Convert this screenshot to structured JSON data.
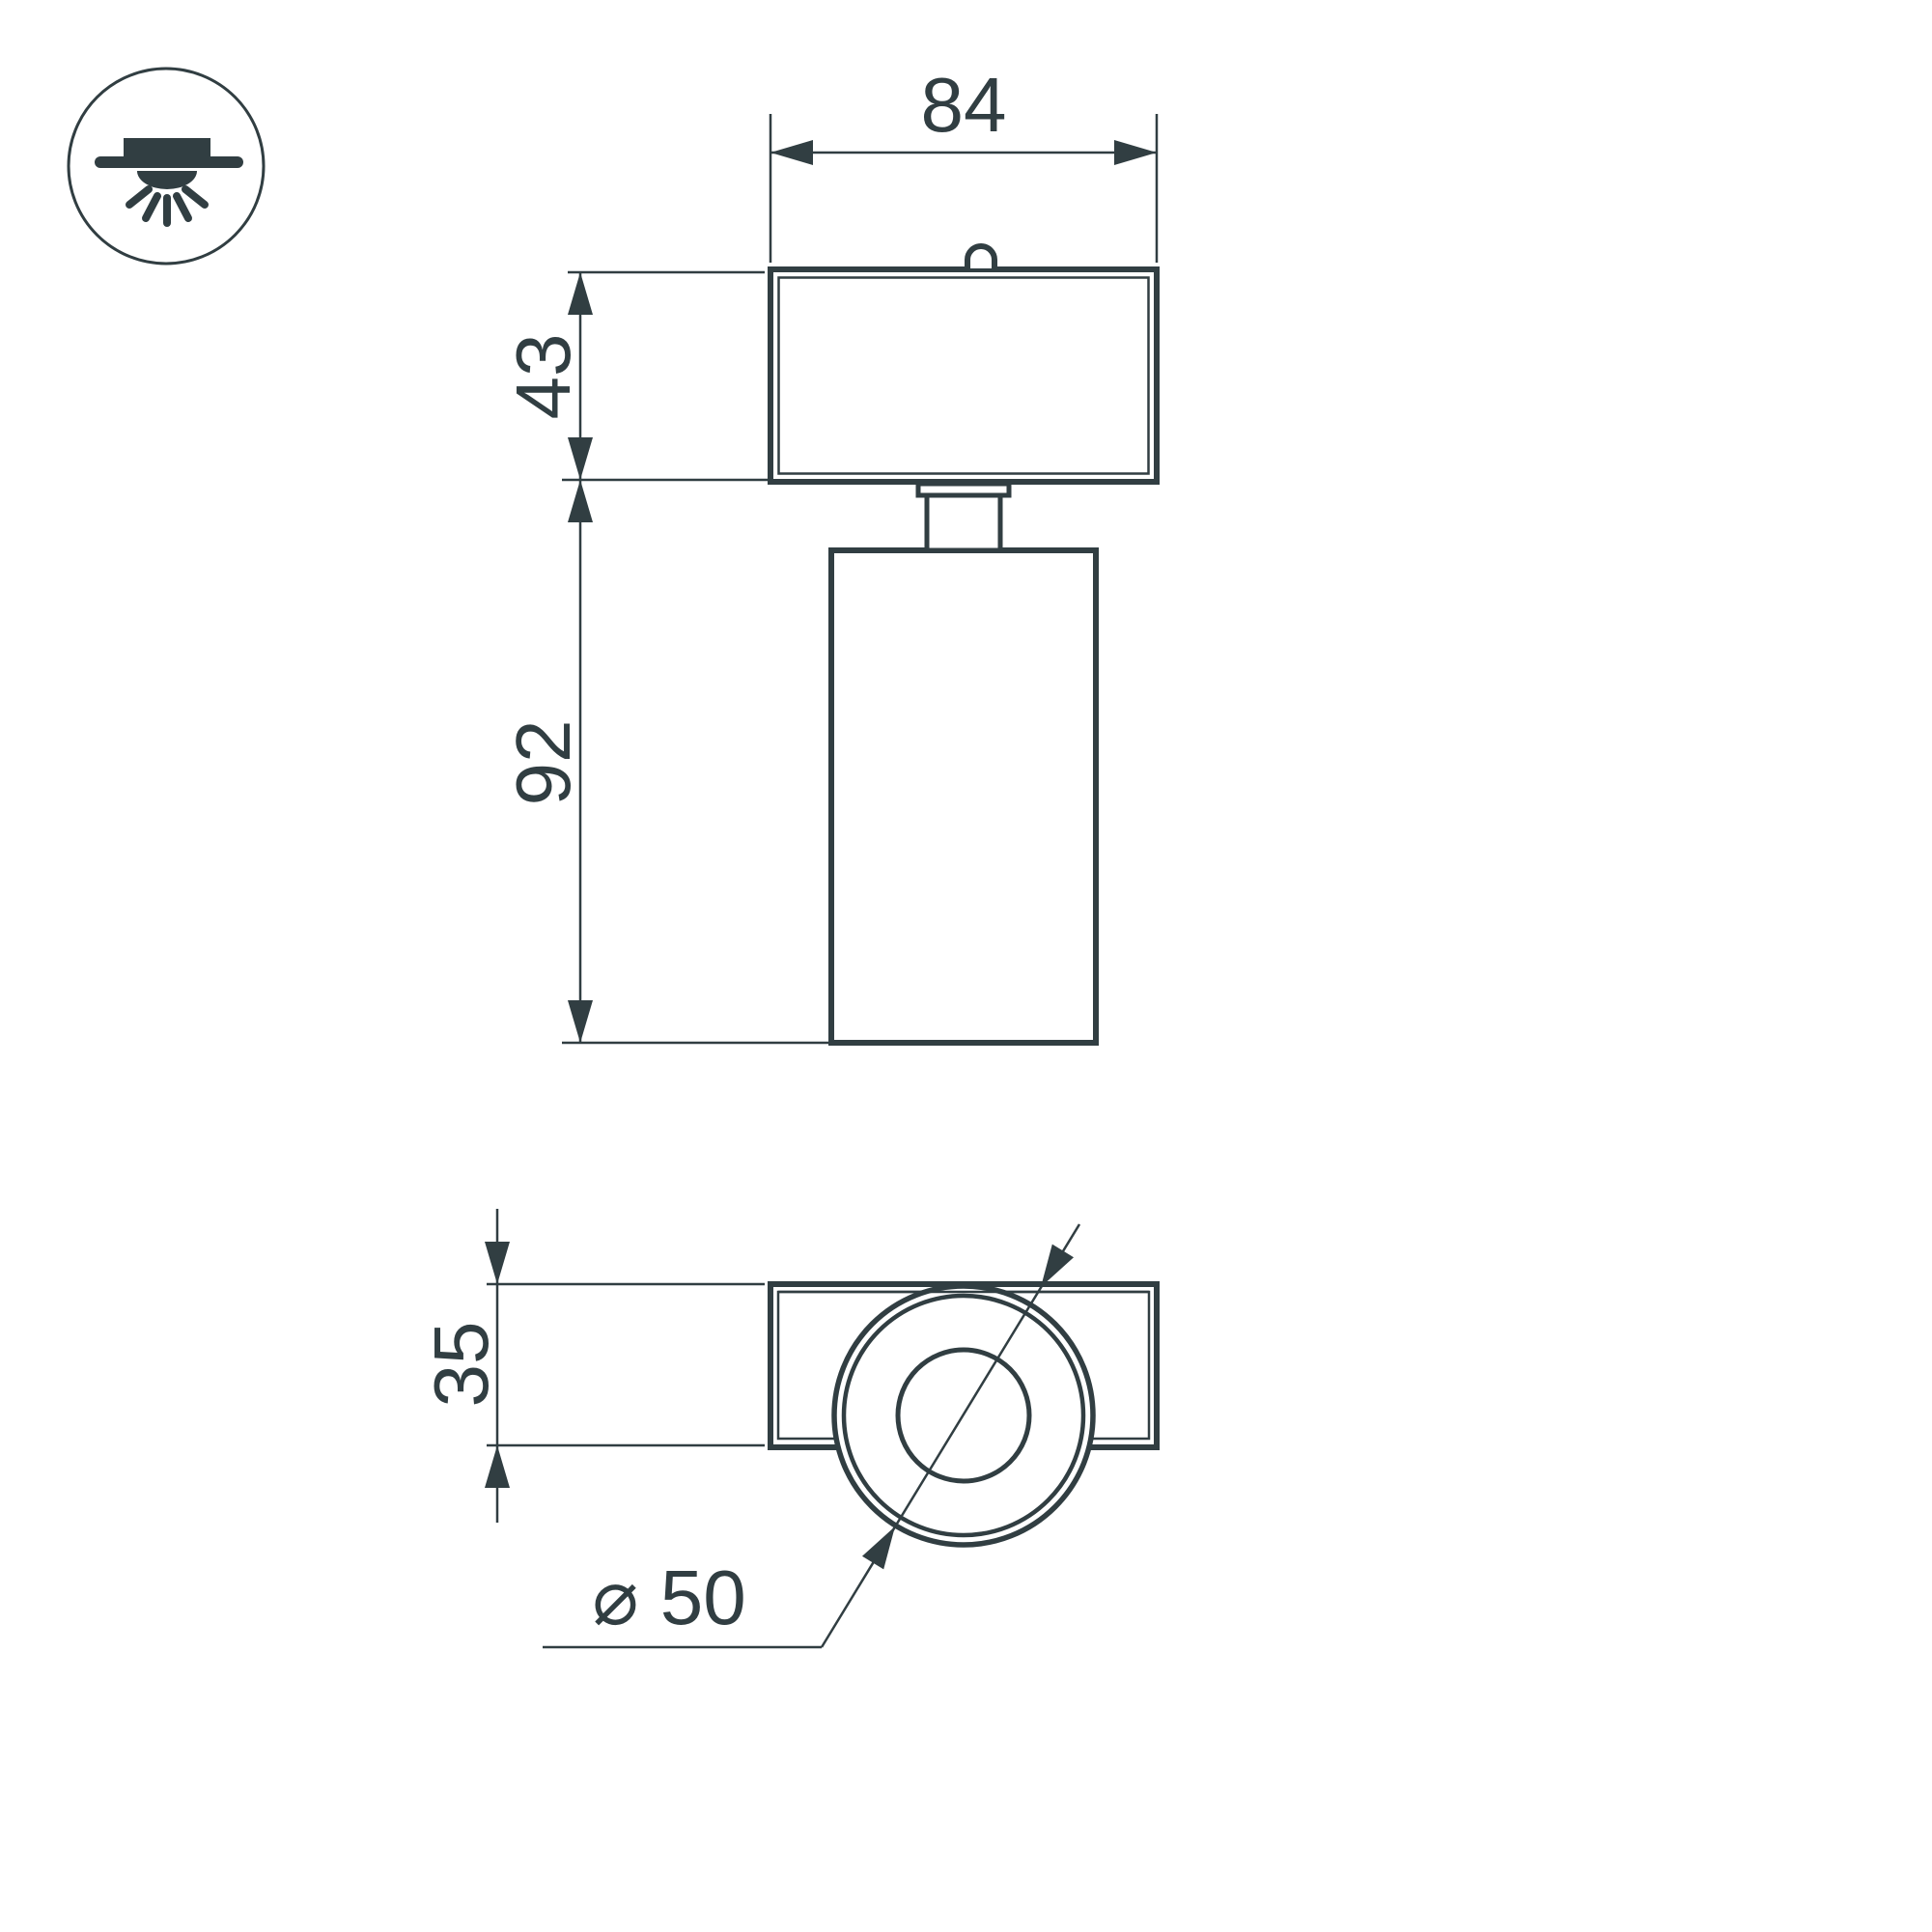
{
  "meta": {
    "background": "#ffffff",
    "line_color": "#313e42"
  },
  "icon": {
    "name": "ceiling-recessed-light-icon"
  },
  "labels": {
    "width": "84",
    "head_height": "43",
    "body_height": "92",
    "base_depth": "35",
    "diameter": "⌀ 50"
  }
}
